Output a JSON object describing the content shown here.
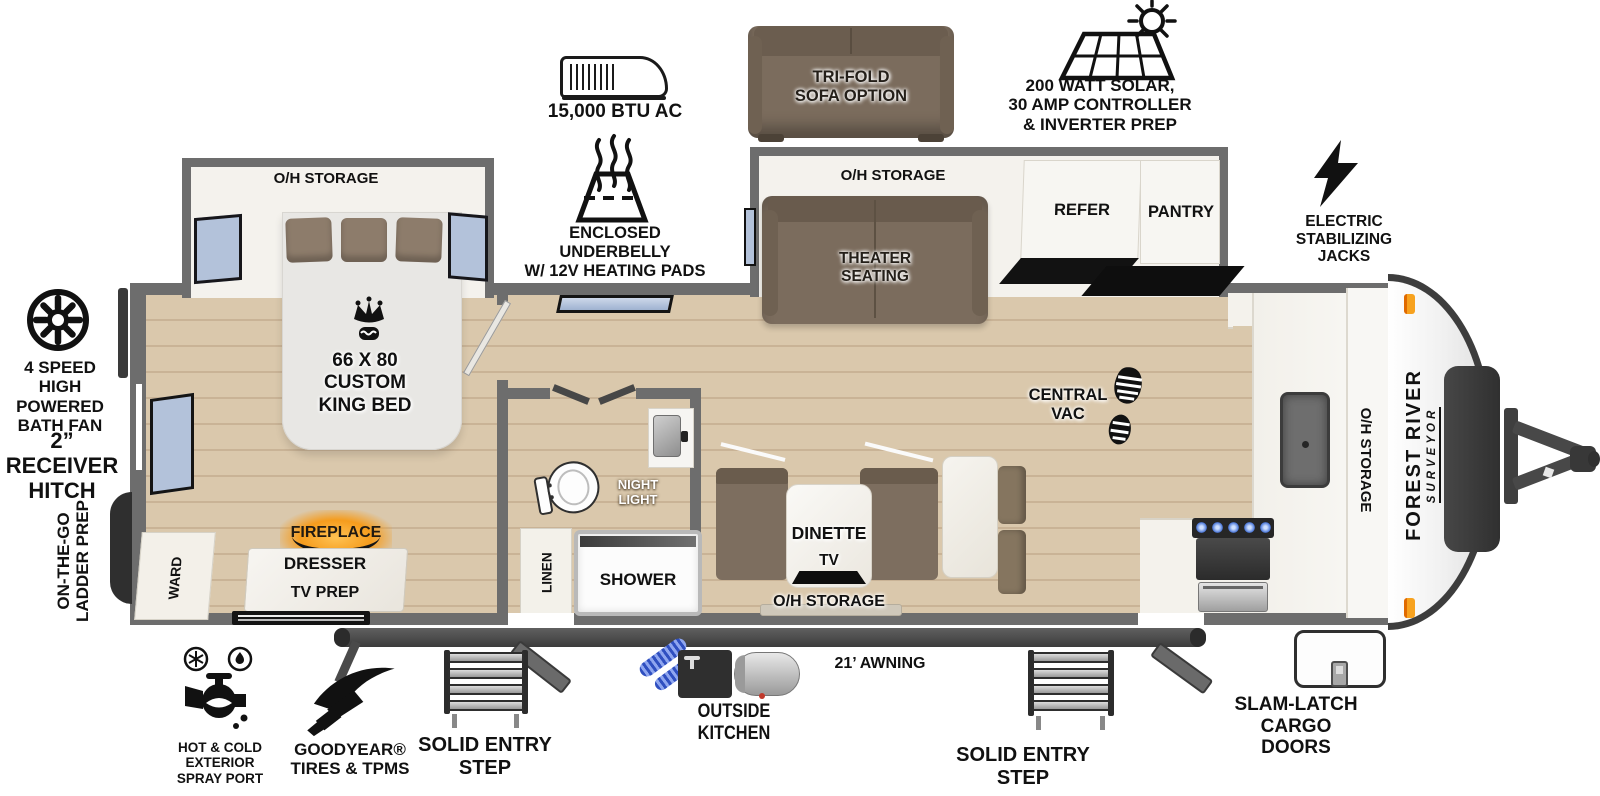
{
  "colors": {
    "wall": "#6d6d6d",
    "floor_wood": "#dac8ac",
    "floor_line": "#c9b396",
    "slide_interior": "#f4f2ed",
    "furniture_brown": "#7b6c5d",
    "pillow_brown": "#8d7c6b",
    "marble_white": "#f6f5f2",
    "window_blue": "#b3c2da",
    "fireplace_orange": "#f59c1d",
    "stove_flame_blue": "#4a76d8",
    "hose_blue": "#3b5bd6",
    "marker_orange": "#f7a21f",
    "icon_black": "#111111"
  },
  "callouts": {
    "ac": "15,000 BTU AC",
    "trifold_sofa": "TRI-FOLD\nSOFA OPTION",
    "solar": "200 WATT SOLAR,\n30 AMP CONTROLLER\n& INVERTER PREP",
    "underbelly": "ENCLOSED UNDERBELLY\nW/ 12V HEATING PADS",
    "stab_jacks": "ELECTRIC\nSTABILIZING\nJACKS",
    "bath_fan": "4 SPEED\nHIGH POWERED\nBATH FAN",
    "receiver_hitch": "2” RECEIVER\nHITCH",
    "ladder_prep": "ON-THE-GO\nLADDER PREP",
    "spray_port": "HOT & COLD EXTERIOR\nSPRAY PORT",
    "goodyear": "GOODYEAR®\nTIRES & TPMS",
    "entry_step_left": "SOLID ENTRY\nSTEP",
    "outside_kitchen": "OUTSIDE KITCHEN",
    "awning": "21’ AWNING",
    "entry_step_right": "SOLID ENTRY\nSTEP",
    "cargo_doors": "SLAM-LATCH\nCARGO DOORS"
  },
  "rooms": {
    "bedroom": {
      "overhead": "O/H STORAGE",
      "bed": "66 X 80\nCUSTOM\nKING BED",
      "ward": "WARD",
      "fireplace": "FIREPLACE",
      "dresser": "DRESSER",
      "tv_prep": "TV PREP"
    },
    "bath": {
      "night_light": "NIGHT\nLIGHT",
      "linen": "LINEN",
      "shower": "SHOWER"
    },
    "living": {
      "overhead": "O/H STORAGE",
      "theater": "THEATER\nSEATING",
      "refer": "REFER",
      "pantry": "PANTRY",
      "central_vac": "CENTRAL\nVAC"
    },
    "dinette": {
      "name": "DINETTE",
      "tv": "TV",
      "overhead": "O/H STORAGE"
    },
    "kitchen": {
      "overhead": "O/H STORAGE"
    }
  },
  "brand": {
    "make": "FOREST RIVER",
    "model": "SURVEYOR"
  }
}
